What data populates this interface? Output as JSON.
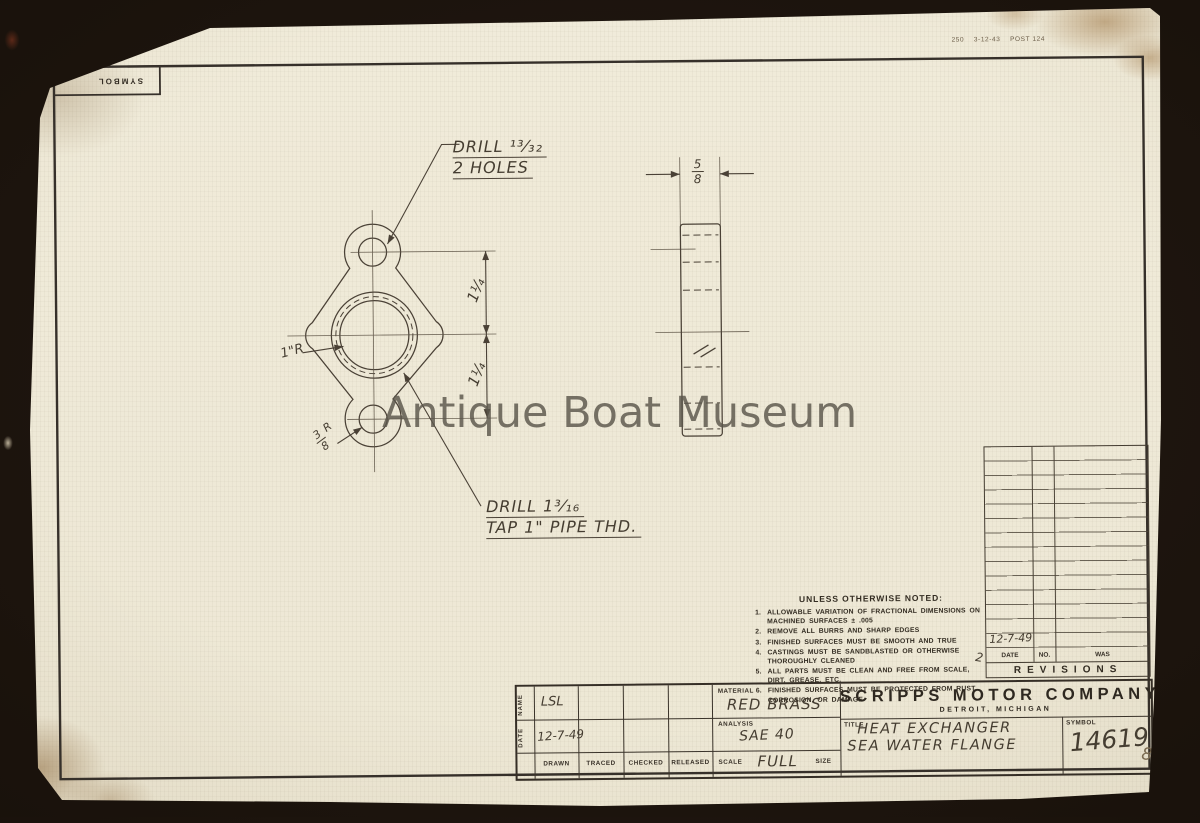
{
  "meta": {
    "print_info": "250    3-12-43    POST 124",
    "page_number": "8"
  },
  "watermark_text": "Antique Boat Museum",
  "symbol_box": {
    "label": "SYMBOL"
  },
  "drawing": {
    "callout_top": {
      "line1": "DRILL  ¹³⁄₃₂",
      "line2": "2 HOLES"
    },
    "callout_bottom": {
      "line1": "DRILL  1³⁄₁₆",
      "line2": "TAP 1\" PIPE THD."
    },
    "radius_left": "1\"R",
    "radius_bottom": {
      "num": "3",
      "den": "8",
      "suffix": "R"
    },
    "dim_vertical_upper": "1¼",
    "dim_vertical_lower": "1¼",
    "dim_thickness": {
      "num": "5",
      "den": "8"
    },
    "pencil_mark": "2"
  },
  "notes": {
    "heading": "UNLESS OTHERWISE NOTED:",
    "items": [
      {
        "num": "1.",
        "text": "ALLOWABLE VARIATION OF FRACTIONAL DIMENSIONS ON MACHINED SURFACES ± .005"
      },
      {
        "num": "2.",
        "text": "REMOVE ALL BURRS AND SHARP EDGES"
      },
      {
        "num": "3.",
        "text": "FINISHED SURFACES MUST BE SMOOTH AND TRUE"
      },
      {
        "num": "4.",
        "text": "CASTINGS MUST BE SANDBLASTED OR OTHERWISE THOROUGHLY CLEANED"
      },
      {
        "num": "5.",
        "text": "ALL PARTS MUST BE CLEAN AND FREE FROM SCALE, DIRT, GREASE, ETC."
      },
      {
        "num": "6.",
        "text": "FINISHED SURFACES MUST BE PROTECTED FROM RUST, CORROSION, OR DAMAGE"
      }
    ]
  },
  "revisions": {
    "footer": "REVISIONS",
    "col_headers": {
      "date": "DATE",
      "no": "NO.",
      "was": "WAS"
    },
    "entry_date": "12-7-49"
  },
  "title_block": {
    "vlabels": {
      "name": "NAME",
      "date": "DATE"
    },
    "values": {
      "name": "LSL",
      "date": "12-7-49"
    },
    "col_headers": [
      "DRAWN",
      "TRACED",
      "CHECKED",
      "RELEASED"
    ],
    "material": {
      "label": "MATERIAL",
      "value": "RED BRASS"
    },
    "analysis": {
      "label": "ANALYSIS",
      "value": "SAE 40"
    },
    "scale": {
      "label": "SCALE",
      "value": "FULL",
      "size_label": "SIZE"
    },
    "company": {
      "name": "SCRIPPS MOTOR COMPANY",
      "location": "DETROIT, MICHIGAN"
    },
    "title": {
      "label": "TITLE",
      "line1": "HEAT EXCHANGER",
      "line2": "SEA WATER FLANGE"
    },
    "symbol": {
      "label": "SYMBOL",
      "value": "14619"
    }
  }
}
